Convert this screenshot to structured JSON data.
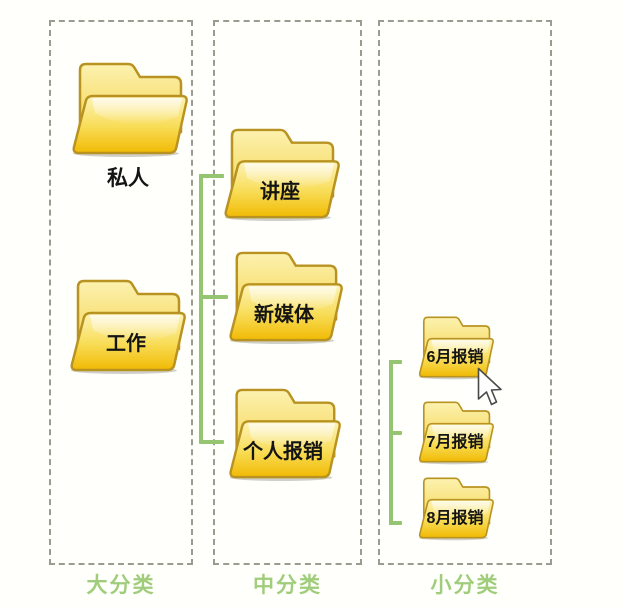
{
  "columns": [
    {
      "label": "大分类",
      "folders": [
        {
          "name": "私人"
        },
        {
          "name": "工作"
        }
      ]
    },
    {
      "label": "中分类",
      "folders": [
        {
          "name": "讲座"
        },
        {
          "name": "新媒体"
        },
        {
          "name": "个人报销"
        }
      ]
    },
    {
      "label": "小分类",
      "folders": [
        {
          "name": "6月报销"
        },
        {
          "name": "7月报销"
        },
        {
          "name": "8月报销"
        }
      ]
    }
  ],
  "icons": {
    "folder": "open-folder-icon",
    "cursor": "arrow-pointer-icon"
  },
  "colors": {
    "connector_green": "#96c571",
    "label_green": "#a0cd7b",
    "folder_yellow": "#f1ba03",
    "folder_border": "#b99322",
    "dashed_border": "#9b9b90",
    "background": "#fffffb"
  }
}
